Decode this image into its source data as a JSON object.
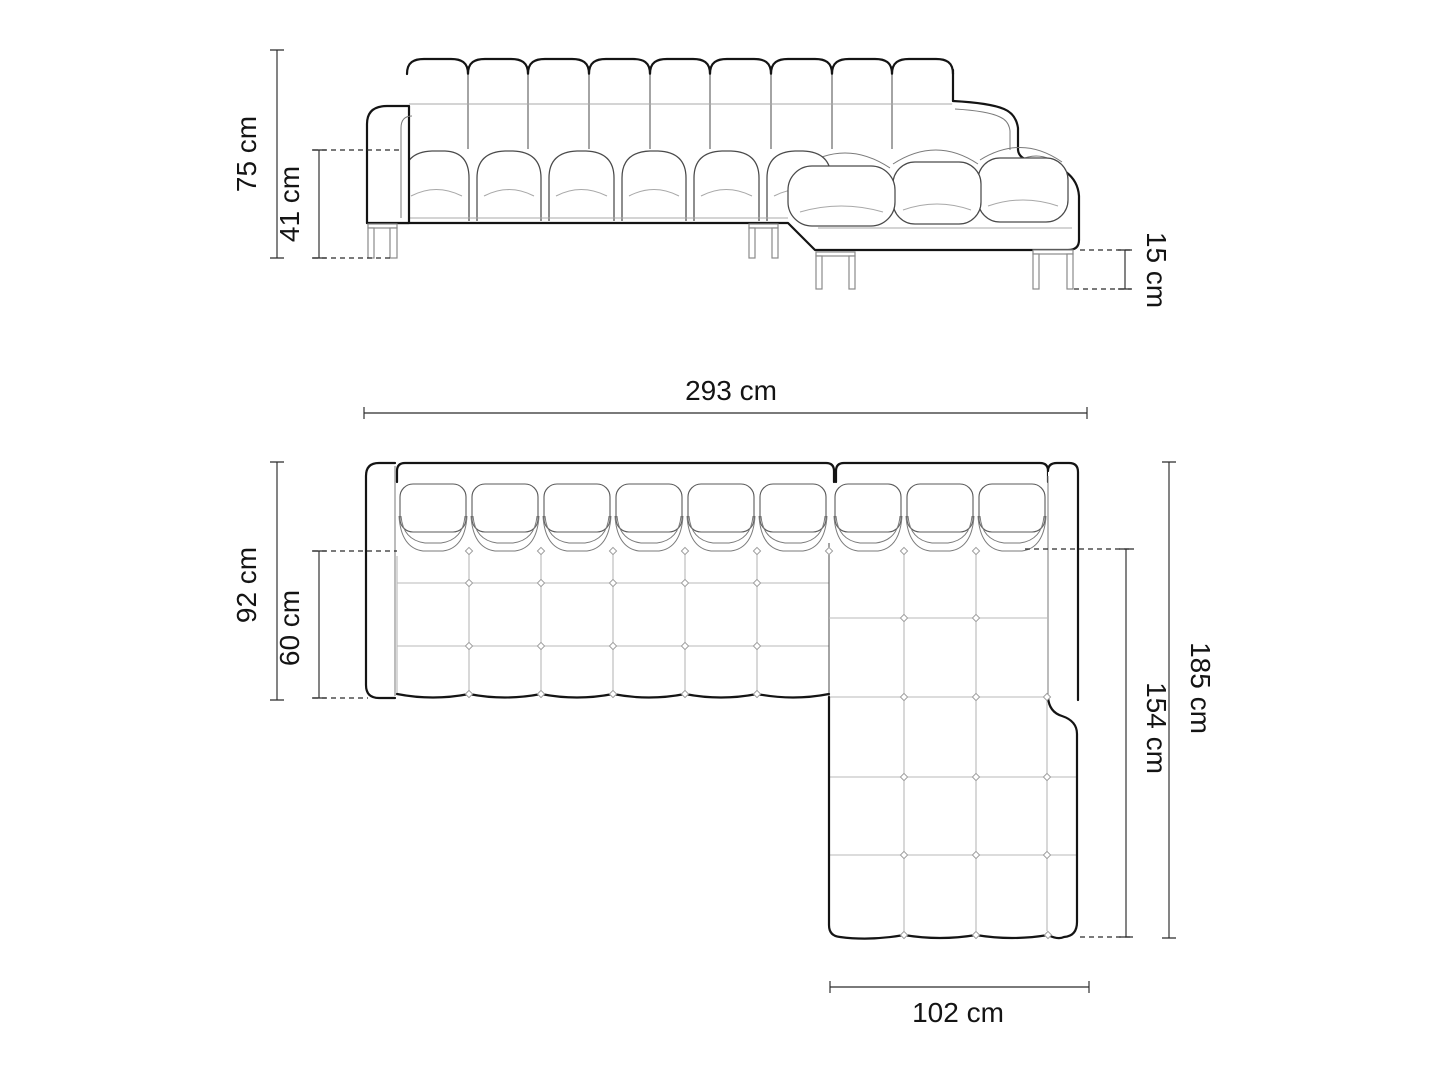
{
  "canvas": {
    "width": 1448,
    "height": 1086,
    "background": "#ffffff"
  },
  "colors": {
    "outline": "#141414",
    "seam": "#7a7a7a",
    "grid": "#b9b9b9",
    "dimension_line": "#2a2a2a",
    "label_text": "#141414"
  },
  "subject": "corner-sofa-with-chaise-technical-drawing",
  "views": {
    "front": {
      "dimensions": {
        "total_height": "75 cm",
        "seat_height": "41 cm",
        "leg_height": "15 cm"
      }
    },
    "top": {
      "dimensions": {
        "total_width": "293 cm",
        "total_depth": "92 cm",
        "seat_depth": "60 cm",
        "total_length": "185 cm",
        "chaise_length": "154 cm",
        "chaise_width": "102 cm"
      }
    }
  }
}
